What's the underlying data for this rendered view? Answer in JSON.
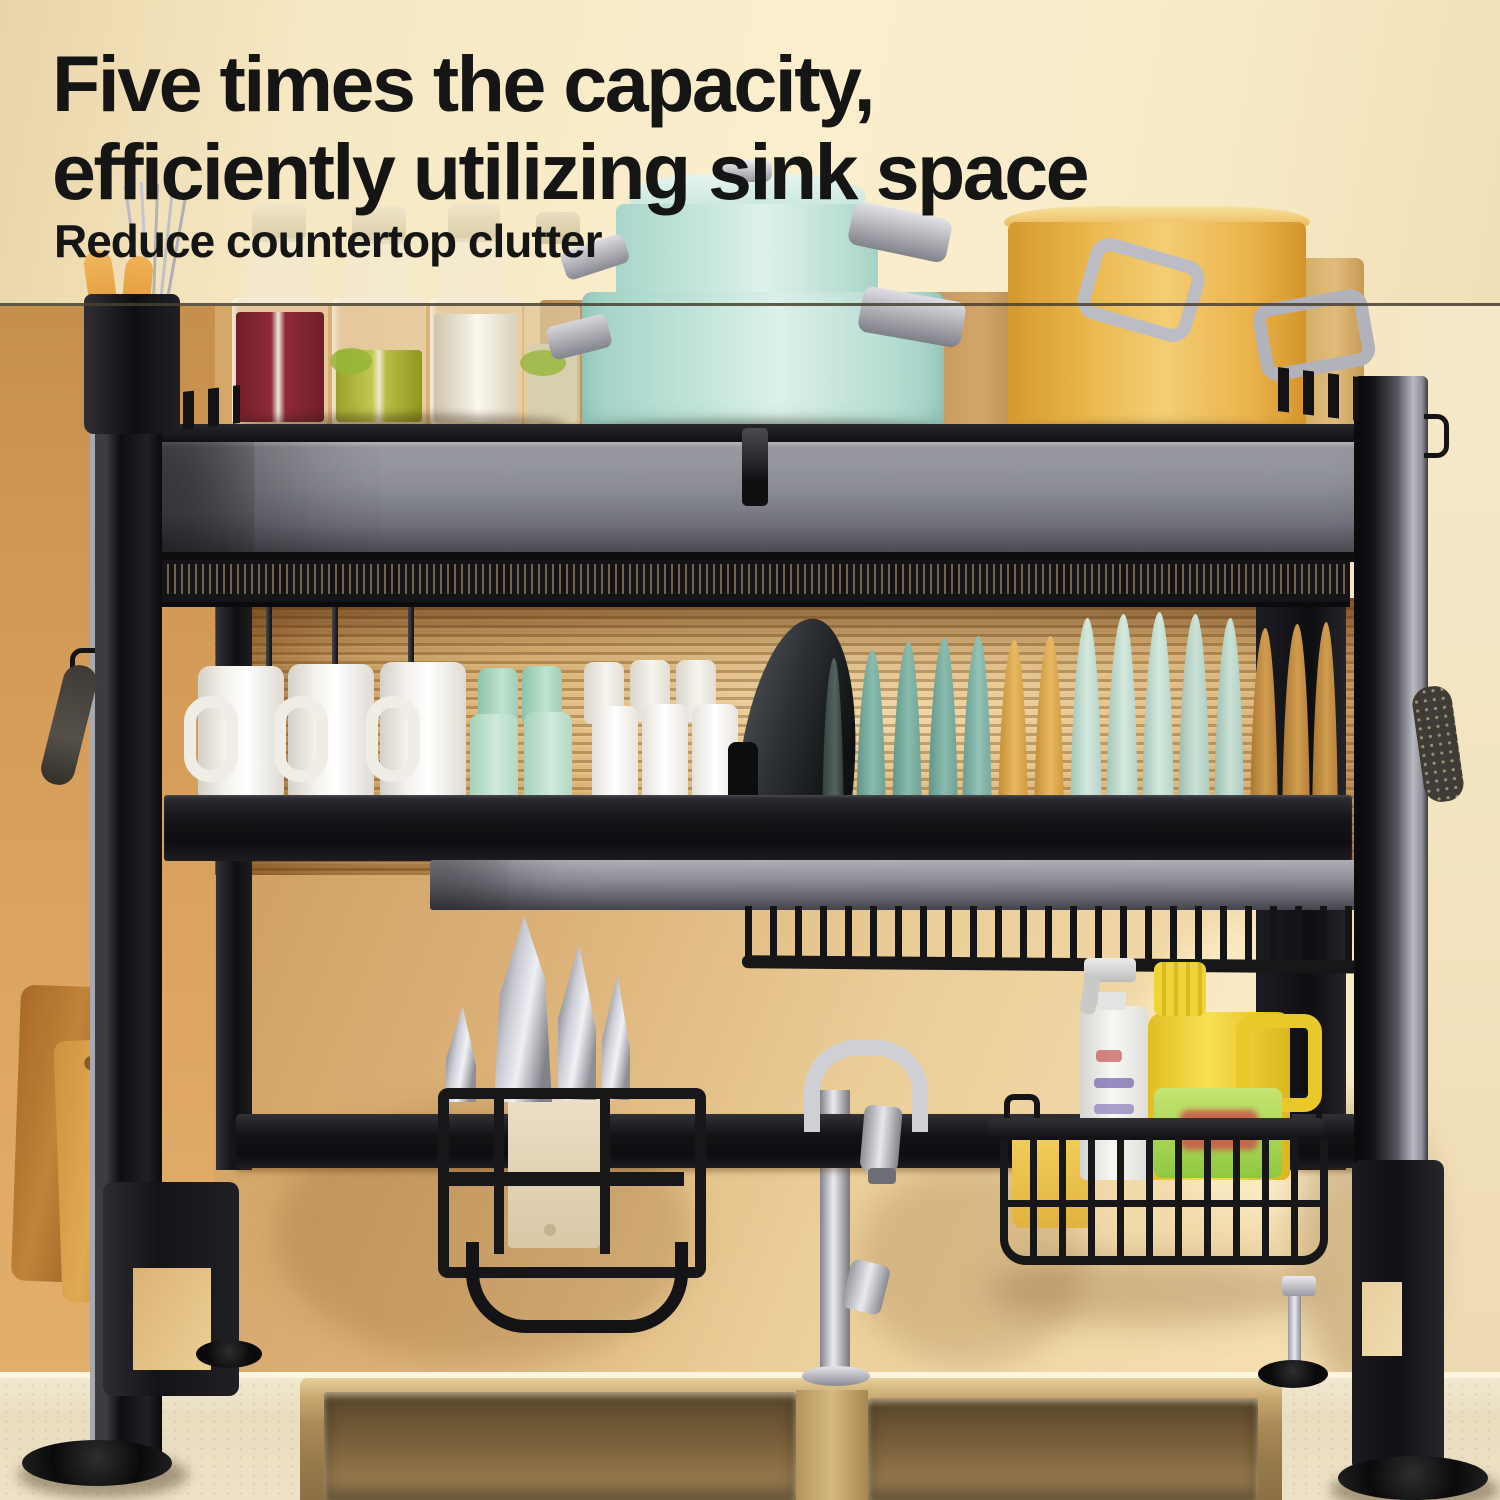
{
  "banner": {
    "headline_line1": "Five times the capacity,",
    "headline_line2": "efficiently utilizing sink space",
    "subheadline": "Reduce countertop clutter",
    "text_color": "#151515",
    "background_color": "#f8ecca"
  },
  "palette": {
    "divider_line": "#4a4236",
    "rack_black": "#101013",
    "rack_silver": "#9a9aa2",
    "wall_orange": "#d49c58",
    "wall_gold": "#ecd0a0",
    "ribbed_glass_amber": "#ddb679",
    "countertop_cream": "#ece0c4",
    "sink_bronze": "#8a6e45",
    "pot_mint": "#c8e8de",
    "pot_yellow": "#eab84e",
    "mug_white": "#f6f4ef",
    "bowl_green": "#bfe3cf",
    "plate_teal": "#86b7ab",
    "plate_yellow": "#dfa94f",
    "plate_mint": "#c9e0d5",
    "plate_tan": "#c9944e",
    "beans_red": "#7e2430",
    "beans_green": "#b7bc3e",
    "beans_white": "#ece6d8",
    "detergent_yellow": "#f0d435",
    "detergent_label_green": "#8fc83f",
    "sponge_yellow": "#eec84e",
    "cutting_board_wood": "#c08338",
    "faucet_chrome": "#d9d9de"
  }
}
